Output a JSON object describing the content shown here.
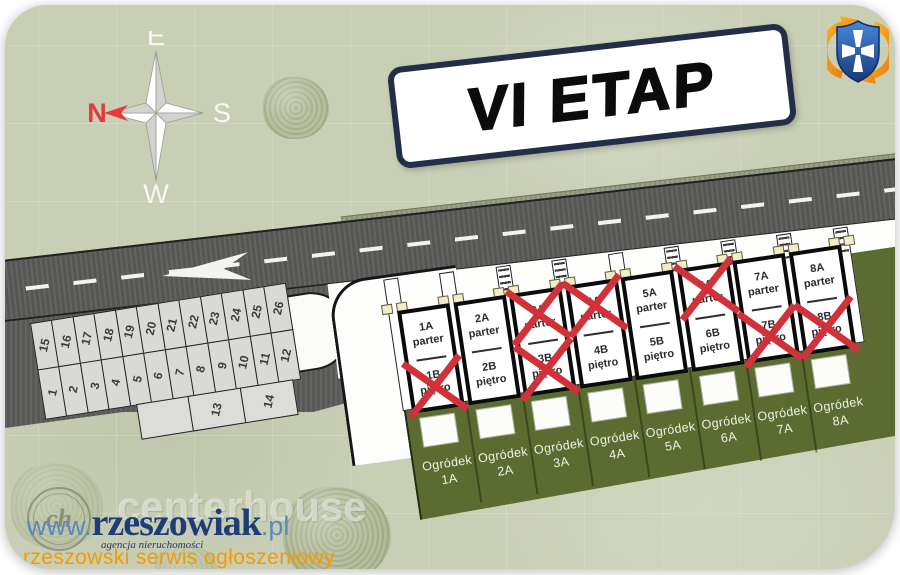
{
  "card": {
    "title": "VI ETAP"
  },
  "compass": {
    "top": "E",
    "right": "S",
    "bottom": "W",
    "left": "N"
  },
  "road": {
    "direction_arrow_icon": "left-direction-arrow"
  },
  "logo_icon": "shield-cross-with-orange-arrows",
  "parking": {
    "back_row": [
      "15",
      "16",
      "17",
      "18",
      "19",
      "20",
      "21",
      "22",
      "23",
      "24",
      "25",
      "26"
    ],
    "front_row": [
      "1",
      "2",
      "3",
      "4",
      "5",
      "6",
      "7",
      "8",
      "9",
      "10",
      "11",
      "12"
    ],
    "side_row": [
      "",
      "13",
      "14"
    ]
  },
  "houses": [
    {
      "id": 1,
      "upper": {
        "unit": "1A",
        "floor": "parter",
        "sold": false
      },
      "lower": {
        "unit": "1B",
        "floor": "piętro",
        "sold": true
      }
    },
    {
      "id": 2,
      "upper": {
        "unit": "2A",
        "floor": "parter",
        "sold": false
      },
      "lower": {
        "unit": "2B",
        "floor": "piętro",
        "sold": false
      }
    },
    {
      "id": 3,
      "upper": {
        "unit": "3A",
        "floor": "parter",
        "sold": true
      },
      "lower": {
        "unit": "3B",
        "floor": "piętro",
        "sold": true
      }
    },
    {
      "id": 4,
      "upper": {
        "unit": "4A",
        "floor": "parter",
        "sold": true
      },
      "lower": {
        "unit": "4B",
        "floor": "piętro",
        "sold": false
      }
    },
    {
      "id": 5,
      "upper": {
        "unit": "5A",
        "floor": "parter",
        "sold": false
      },
      "lower": {
        "unit": "5B",
        "floor": "piętro",
        "sold": false
      }
    },
    {
      "id": 6,
      "upper": {
        "unit": "6A",
        "floor": "parter",
        "sold": true
      },
      "lower": {
        "unit": "6B",
        "floor": "piętro",
        "sold": false
      }
    },
    {
      "id": 7,
      "upper": {
        "unit": "7A",
        "floor": "parter",
        "sold": false
      },
      "lower": {
        "unit": "7B",
        "floor": "piętro",
        "sold": true
      }
    },
    {
      "id": 8,
      "upper": {
        "unit": "8A",
        "floor": "parter",
        "sold": false
      },
      "lower": {
        "unit": "8B",
        "floor": "piętro",
        "sold": true
      }
    }
  ],
  "gardens": {
    "word": "Ogródek",
    "plots": [
      "1A",
      "2A",
      "3A",
      "4A",
      "5A",
      "6A",
      "7A",
      "8A"
    ]
  },
  "stairs_boundaries": [
    2,
    3,
    5,
    6,
    7,
    8
  ],
  "watermark": {
    "ghost_monogram": "ch",
    "ghost_text": "centerhouse",
    "url_prefix": "www.",
    "url_main": "rzeszowiak",
    "url_suffix": ".pl",
    "agency_line": "agencja nieruchomości",
    "tagline": "rzeszowski serwis ogłoszeniowy"
  },
  "colors": {
    "background_sage": "#c9cfb5",
    "garden_olive": "#5c6c31",
    "road_gray": "#5b5b59",
    "sold_x_red": "#d13239",
    "title_border_navy": "#242e49",
    "watermark_navy": "#1e3c78",
    "watermark_blue": "#5d87bd",
    "watermark_orange": "#f59b00",
    "compass_north_red": "#e23b3b"
  }
}
